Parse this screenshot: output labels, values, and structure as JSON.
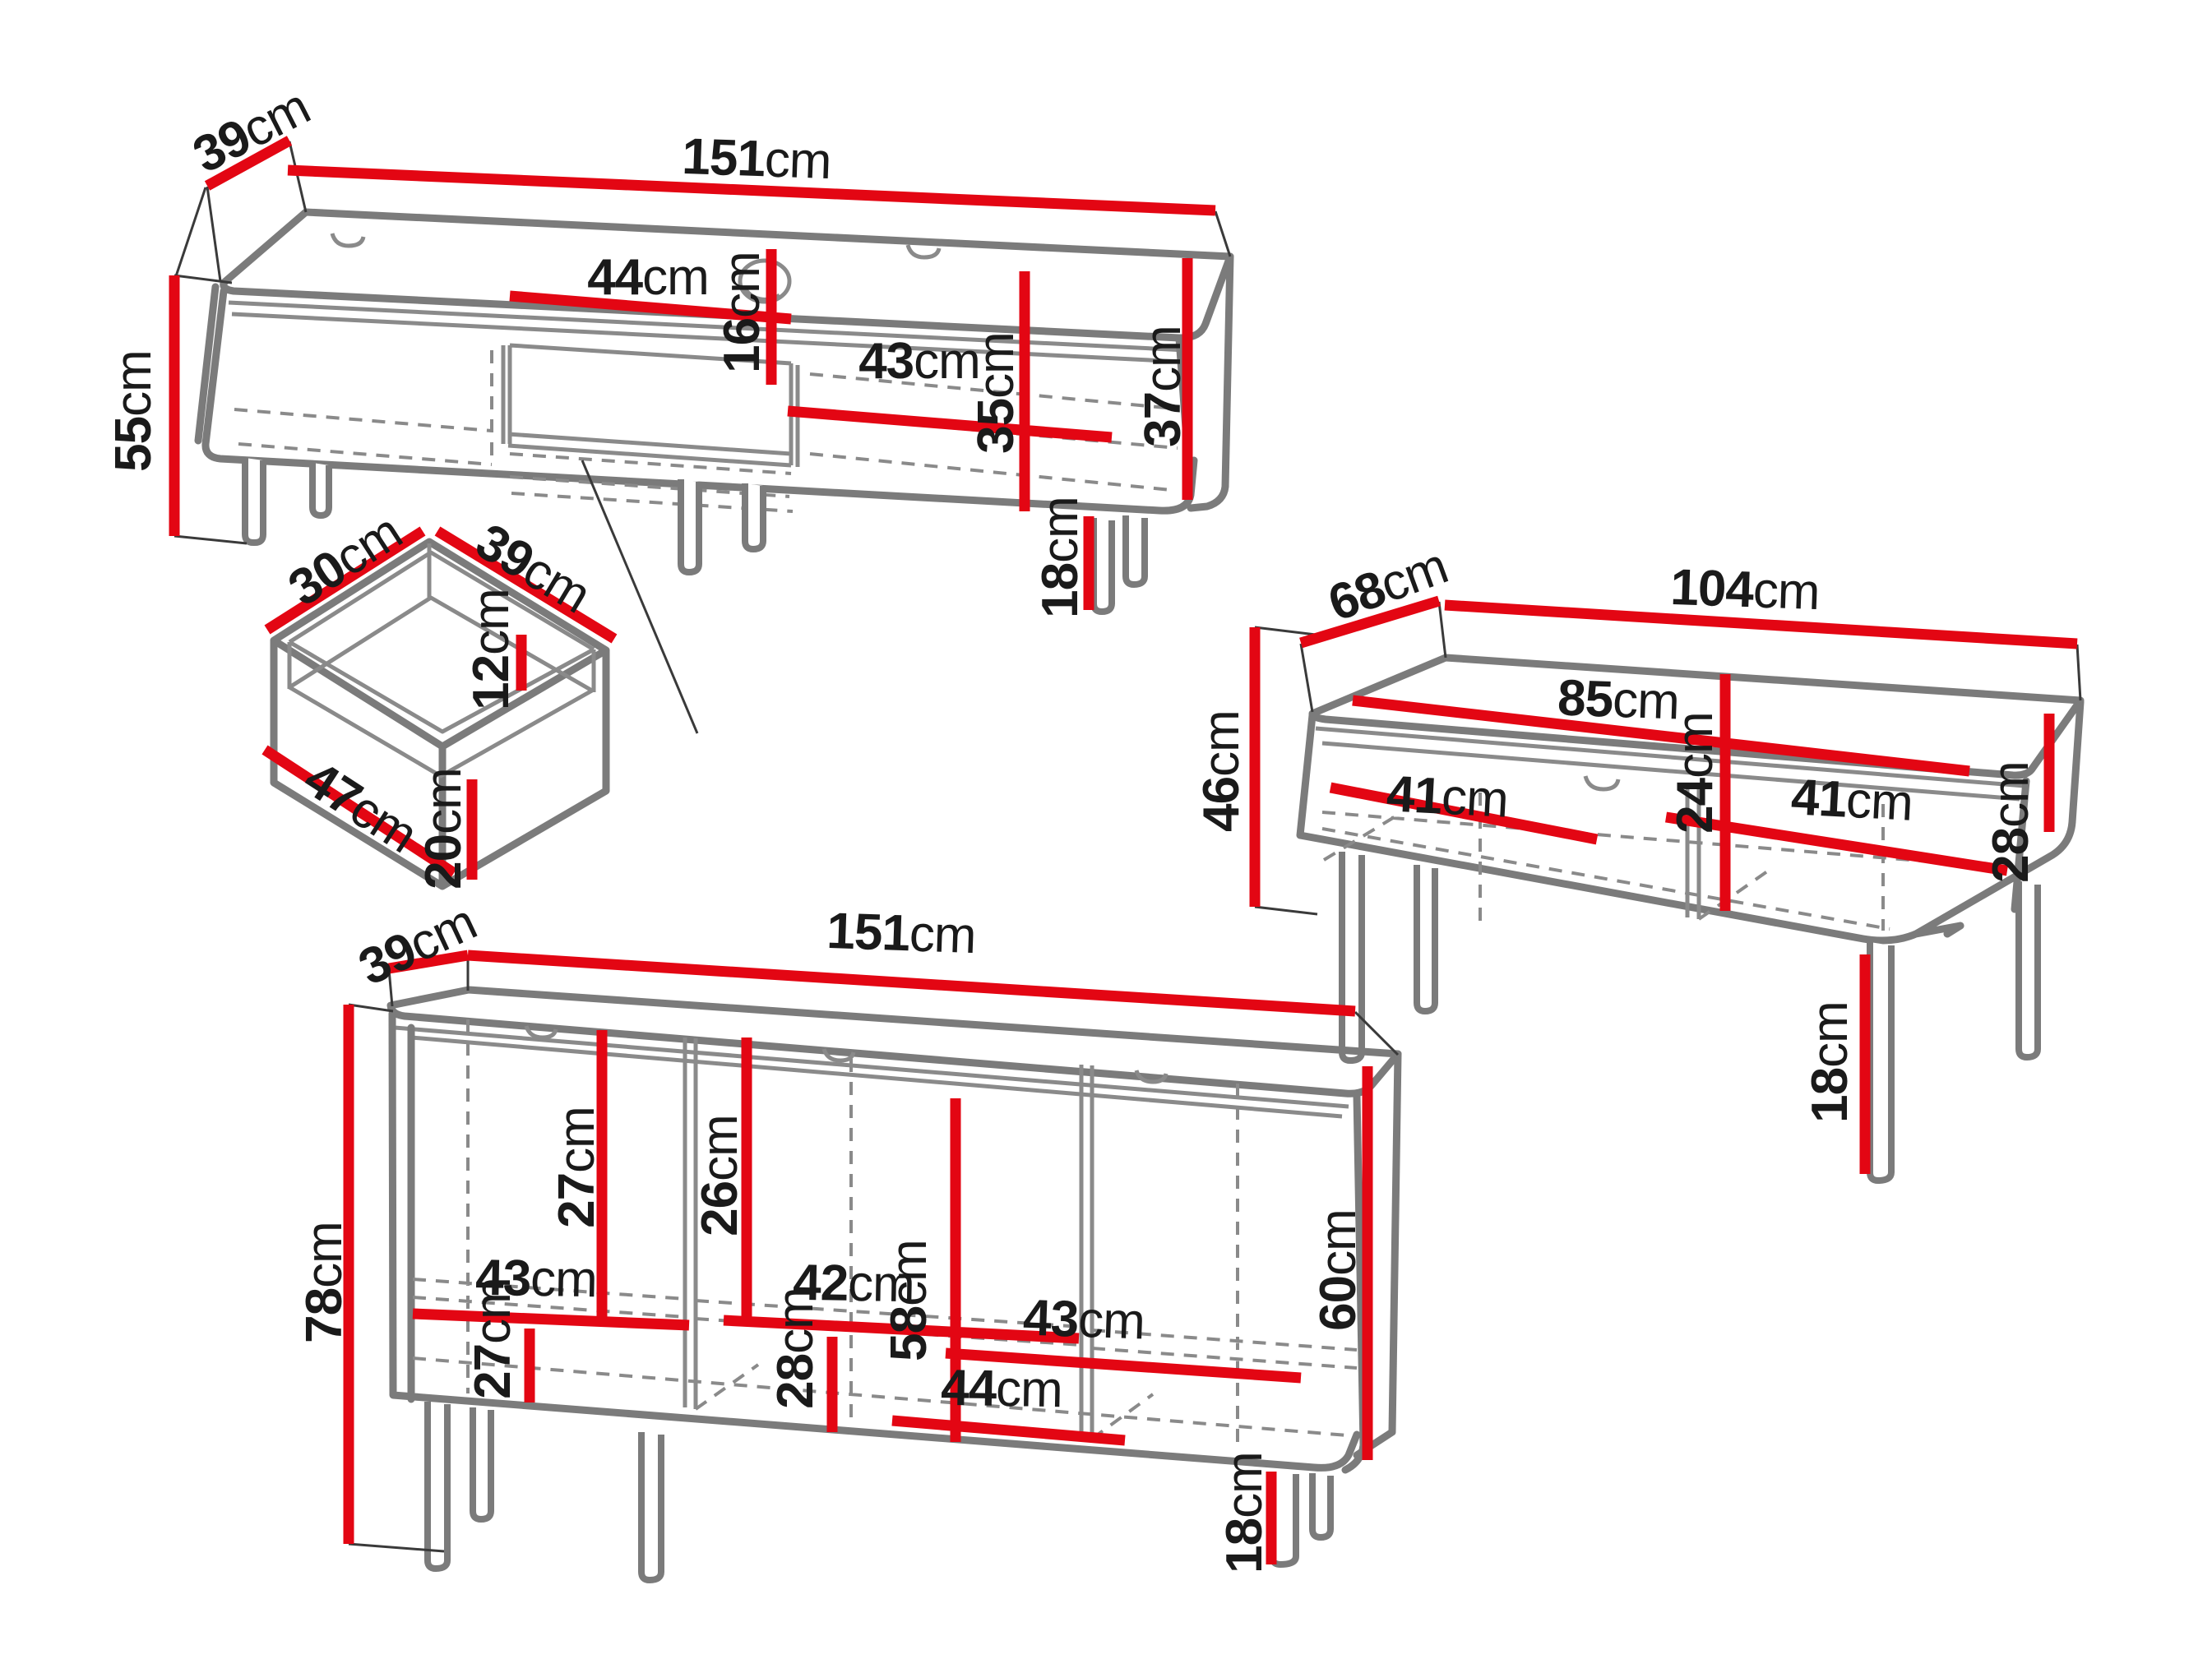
{
  "colors": {
    "dimension_line": "#e30613",
    "outline": "#7b7b7b",
    "text": "#1a1a1a",
    "background": "#ffffff"
  },
  "pieces": [
    {
      "id": "tv-stand",
      "dims": [
        {
          "value": "39",
          "unit": "cm"
        },
        {
          "value": "151",
          "unit": "cm"
        },
        {
          "value": "55",
          "unit": "cm"
        },
        {
          "value": "44",
          "unit": "cm"
        },
        {
          "value": "16",
          "unit": "cm"
        },
        {
          "value": "43",
          "unit": "cm"
        },
        {
          "value": "35",
          "unit": "cm"
        },
        {
          "value": "37",
          "unit": "cm"
        },
        {
          "value": "18",
          "unit": "cm"
        }
      ]
    },
    {
      "id": "drawer-detail",
      "dims": [
        {
          "value": "30",
          "unit": "cm"
        },
        {
          "value": "39",
          "unit": "cm"
        },
        {
          "value": "12",
          "unit": "cm"
        },
        {
          "value": "47",
          "unit": "cm"
        },
        {
          "value": "20",
          "unit": "cm"
        }
      ]
    },
    {
      "id": "coffee-table",
      "dims": [
        {
          "value": "68",
          "unit": "cm"
        },
        {
          "value": "104",
          "unit": "cm"
        },
        {
          "value": "46",
          "unit": "cm"
        },
        {
          "value": "85",
          "unit": "cm"
        },
        {
          "value": "24",
          "unit": "cm"
        },
        {
          "value": "41",
          "unit": "cm"
        },
        {
          "value": "41",
          "unit": "cm"
        },
        {
          "value": "28",
          "unit": "cm"
        },
        {
          "value": "18",
          "unit": "cm"
        }
      ]
    },
    {
      "id": "sideboard",
      "dims": [
        {
          "value": "39",
          "unit": "cm"
        },
        {
          "value": "151",
          "unit": "cm"
        },
        {
          "value": "78",
          "unit": "cm"
        },
        {
          "value": "27",
          "unit": "cm"
        },
        {
          "value": "43",
          "unit": "cm"
        },
        {
          "value": "26",
          "unit": "cm"
        },
        {
          "value": "42",
          "unit": "cm"
        },
        {
          "value": "43",
          "unit": "cm"
        },
        {
          "value": "60",
          "unit": "cm"
        },
        {
          "value": "27",
          "unit": "cm"
        },
        {
          "value": "28",
          "unit": "cm"
        },
        {
          "value": "58",
          "unit": "cm"
        },
        {
          "value": "44",
          "unit": "cm"
        },
        {
          "value": "18",
          "unit": "cm"
        }
      ]
    }
  ]
}
